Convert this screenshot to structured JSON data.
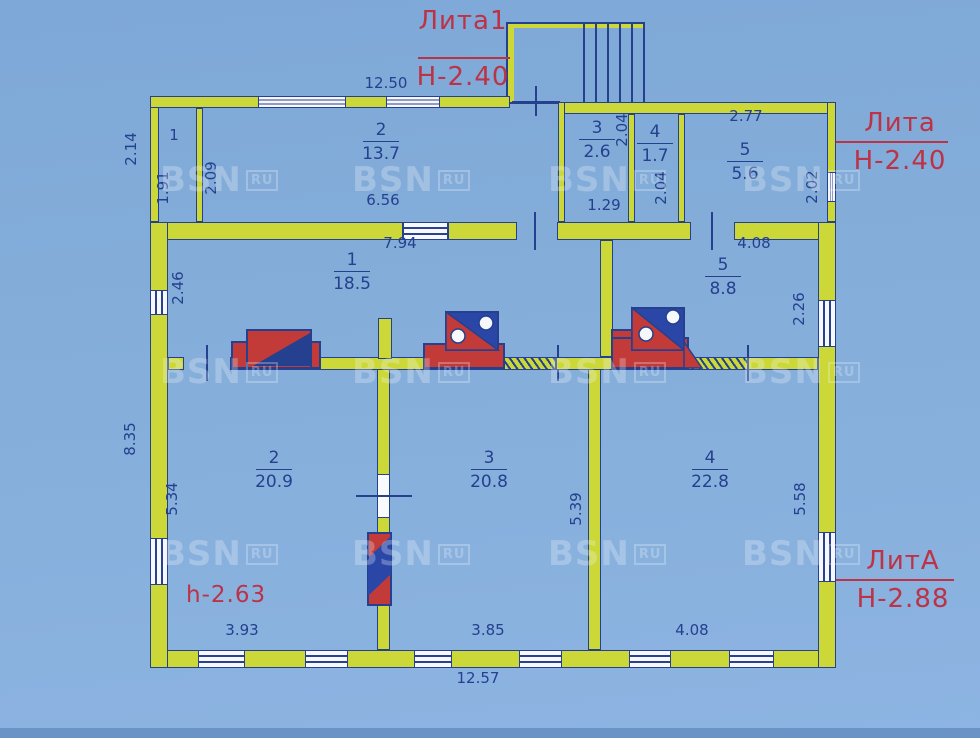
{
  "watermark": {
    "text": "BSN",
    "badge": "RU"
  },
  "annotations": {
    "lita1": {
      "title": "Лита1",
      "height": "Н-2.40"
    },
    "lita": {
      "title": "Лита",
      "height": "Н-2.40"
    },
    "litA": {
      "title": "ЛитА",
      "height": "Н-2.88"
    },
    "ceiling_height": "h-2.63"
  },
  "annex": {
    "rooms": [
      {
        "num": "1",
        "area": ""
      },
      {
        "num": "2",
        "area": "13.7"
      },
      {
        "num": "3",
        "area": "2.6"
      },
      {
        "num": "4",
        "area": "1.7"
      },
      {
        "num": "5",
        "area": "5.6"
      }
    ],
    "dims": {
      "top_width": "12.50",
      "left_outside": "2.14",
      "room1_height": "1.91",
      "room2_left": "2.09",
      "room2_width": "6.56",
      "room3_right": "2.04",
      "room3_width": "1.29",
      "room4_below": "2.04",
      "room5_width": "2.77",
      "room5_right": "2.02"
    }
  },
  "main": {
    "rooms": [
      {
        "num": "1",
        "area": "18.5"
      },
      {
        "num": "2",
        "area": "20.9"
      },
      {
        "num": "3",
        "area": "20.8"
      },
      {
        "num": "4",
        "area": "22.8"
      },
      {
        "num": "5",
        "area": "8.8"
      }
    ],
    "dims": {
      "hall_top": "7.94",
      "hall_left": "2.46",
      "room5_top": "4.08",
      "room5_right": "2.26",
      "left_outside": "8.35",
      "room2_left": "5.34",
      "room3_right": "5.39",
      "room4_right": "5.58",
      "room2_bottom": "3.93",
      "room3_bottom": "3.85",
      "room4_bottom": "4.08",
      "bottom_width": "12.57"
    }
  }
}
